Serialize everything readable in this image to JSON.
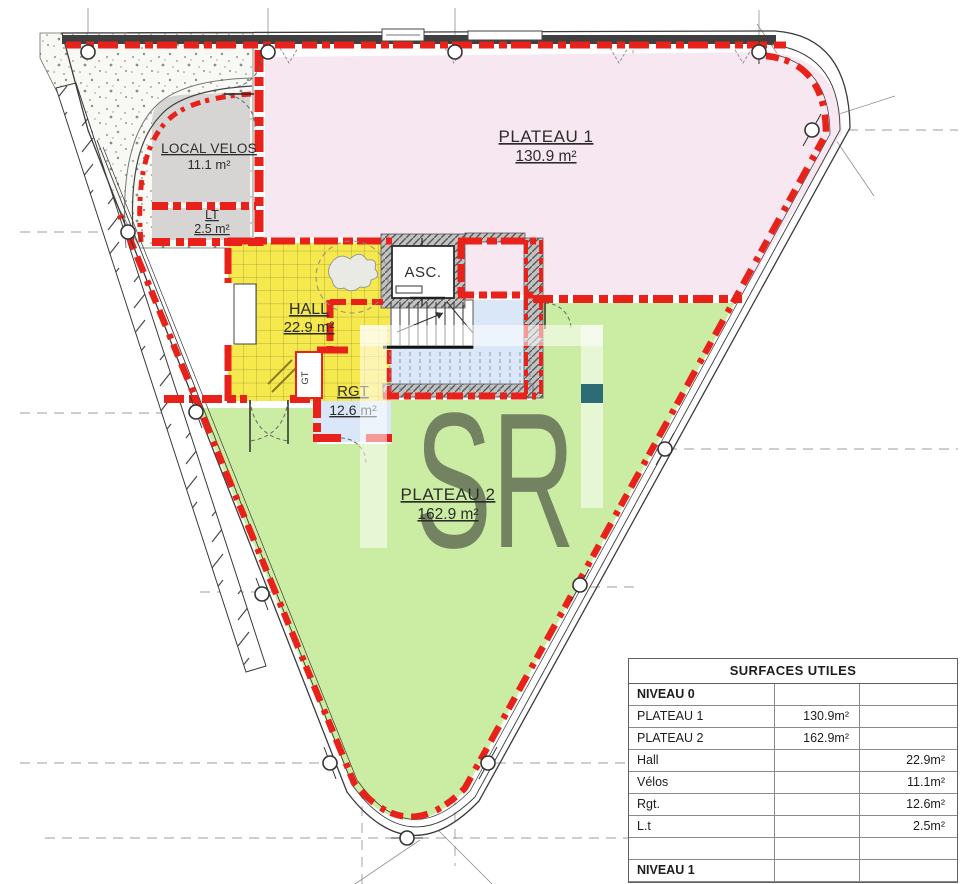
{
  "plan": {
    "watermark": {
      "letters": "SR"
    },
    "rooms": {
      "plateau1": {
        "name": "PLATEAU 1",
        "area": "130.9 m²"
      },
      "plateau2": {
        "name": "PLATEAU 2",
        "area": "162.9 m²"
      },
      "hall": {
        "name": "HALL",
        "area": "22.9 m²"
      },
      "velos": {
        "name": "LOCAL VELOS",
        "area": "11.1 m²"
      },
      "lt": {
        "name": "LT",
        "area": "2.5 m²"
      },
      "rgt": {
        "name": "RGT",
        "area": "12.6 m²"
      },
      "asc": {
        "name": "ASC."
      },
      "gt": {
        "name": "GT"
      }
    },
    "colors": {
      "wall_red": "#e8211a",
      "plateau1_fill": "#f7e7f1",
      "plateau2_fill": "#cbeca3",
      "hall_fill": "#f6e94e",
      "stair_fill": "#d9e7f8",
      "service_fill": "#d6d5d3",
      "teal_marker": "#2d6c77"
    }
  },
  "table": {
    "title": "SURFACES UTILES",
    "rows": [
      {
        "label": "NIVEAU 0",
        "col2": "",
        "col3": "",
        "bold": true
      },
      {
        "label": "PLATEAU 1",
        "col2": "130.9m²",
        "col3": "",
        "bold": false
      },
      {
        "label": "PLATEAU 2",
        "col2": "162.9m²",
        "col3": "",
        "bold": false
      },
      {
        "label": "Hall",
        "col2": "",
        "col3": "22.9m²",
        "bold": false
      },
      {
        "label": "Vélos",
        "col2": "",
        "col3": "11.1m²",
        "bold": false
      },
      {
        "label": "Rgt.",
        "col2": "",
        "col3": "12.6m²",
        "bold": false
      },
      {
        "label": "L.t",
        "col2": "",
        "col3": "2.5m²",
        "bold": false
      },
      {
        "label": "",
        "col2": "",
        "col3": "",
        "bold": false
      },
      {
        "label": "NIVEAU 1",
        "col2": "",
        "col3": "",
        "bold": true
      }
    ]
  }
}
